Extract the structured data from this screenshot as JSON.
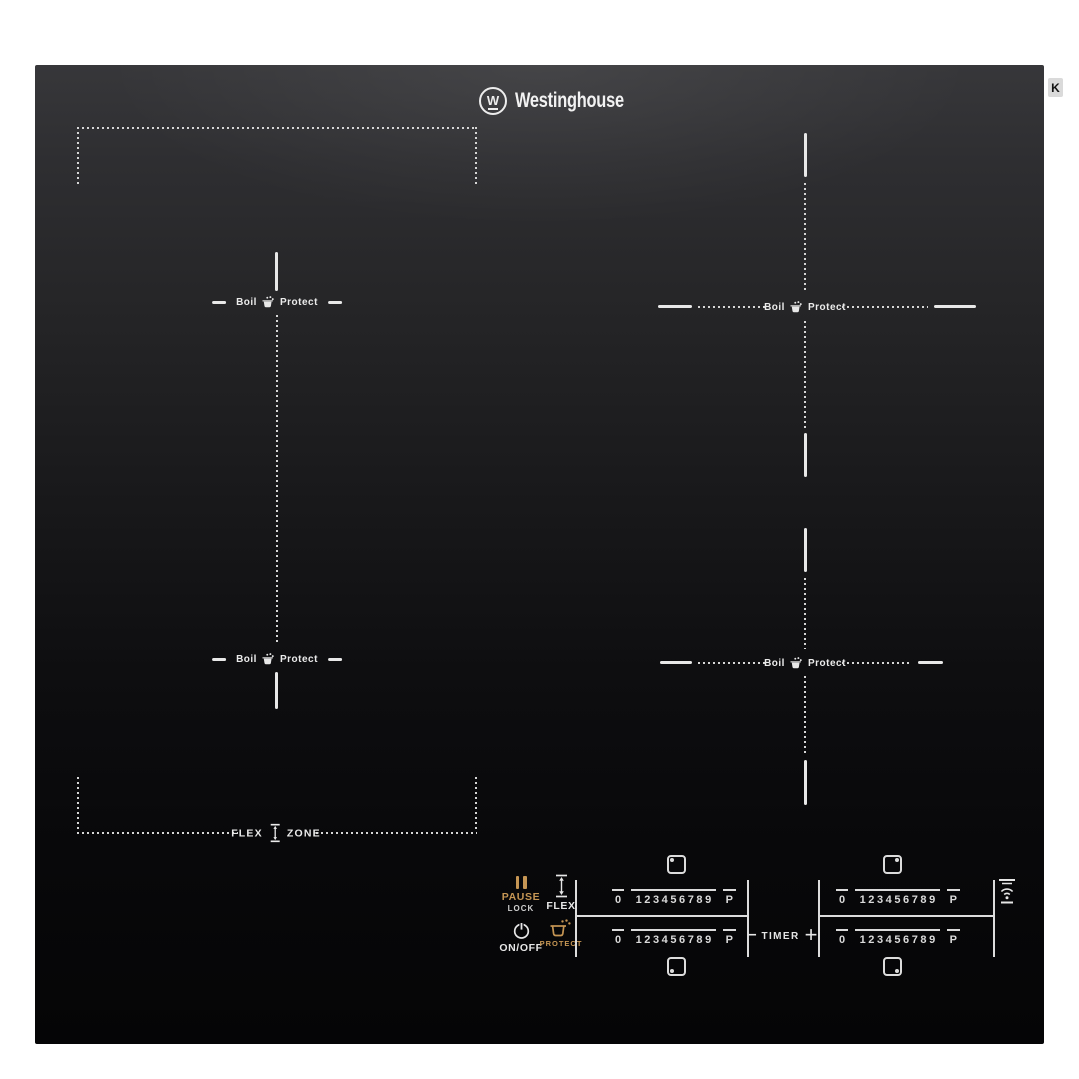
{
  "brand": {
    "monogram": "W",
    "wordmark": "Westinghouse"
  },
  "watermark": "K",
  "zones": {
    "boil_word": "Boil",
    "protect_word": "Protect",
    "flex_word": "FLEX",
    "zone_word": "ZONE"
  },
  "controls": {
    "pause": {
      "label": "PAUSE",
      "sublabel": "LOCK"
    },
    "flex": {
      "label": "FLEX"
    },
    "power": {
      "label": "ON/OFF"
    },
    "protect": {
      "label": "PROTECT"
    },
    "timer": {
      "label": "TIMER",
      "minus": "–",
      "plus": "+"
    },
    "power_scale": [
      "0",
      "1",
      "2",
      "3",
      "4",
      "5",
      "6",
      "7",
      "8",
      "9",
      "P"
    ]
  },
  "colors": {
    "page_bg": "#ffffff",
    "glass_dark": "#0a0a0b",
    "marking_white": "#e6e6e6",
    "accent_gold": "#c69654"
  }
}
